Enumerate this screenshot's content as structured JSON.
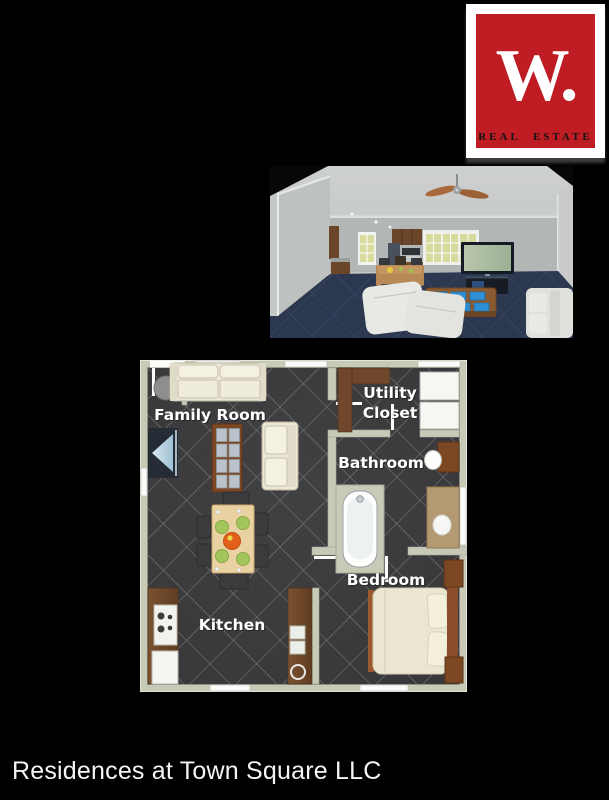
{
  "logo": {
    "monogram": "W.",
    "caption": "REAL  ESTATE",
    "colors": {
      "red": "#c01c24",
      "card": "#ffffff",
      "monogram_text": "#ffffff",
      "caption_text": "#141414"
    }
  },
  "photo": {
    "colors": {
      "walls": "#bfc3c2",
      "ceiling": "#c9ccca",
      "carpet": "#2c3850",
      "carpet_grid": "#49587a",
      "window_glass": "#d8dc9e",
      "cabinet_wood": "#6a452a",
      "coffee_table_wood": "#8a5a30",
      "placemats": "#2e8fd4",
      "sofa": "#e8e9e4",
      "tv_screen": "#aebfa3"
    }
  },
  "floorplan": {
    "labels": {
      "family_room": "Family Room",
      "utility_line1": "Utility",
      "utility_line2": "Closet",
      "bathroom": "Bathroom",
      "bedroom": "Bedroom",
      "kitchen": "Kitchen"
    },
    "colors": {
      "wall": "#c8cab8",
      "floor": "#3c3c3e",
      "tile_grid": "#90908c",
      "wood": "#7c4722",
      "counter_wood": "#6f472a",
      "cream_furniture": "#ece8d6",
      "plate_green": "#a4c45c",
      "bowl_orange": "#e2611a",
      "table_tan": "#ead1a1",
      "vanity_tan": "#b49a72"
    }
  },
  "footer": {
    "title": "Residences at Town Square LLC"
  }
}
